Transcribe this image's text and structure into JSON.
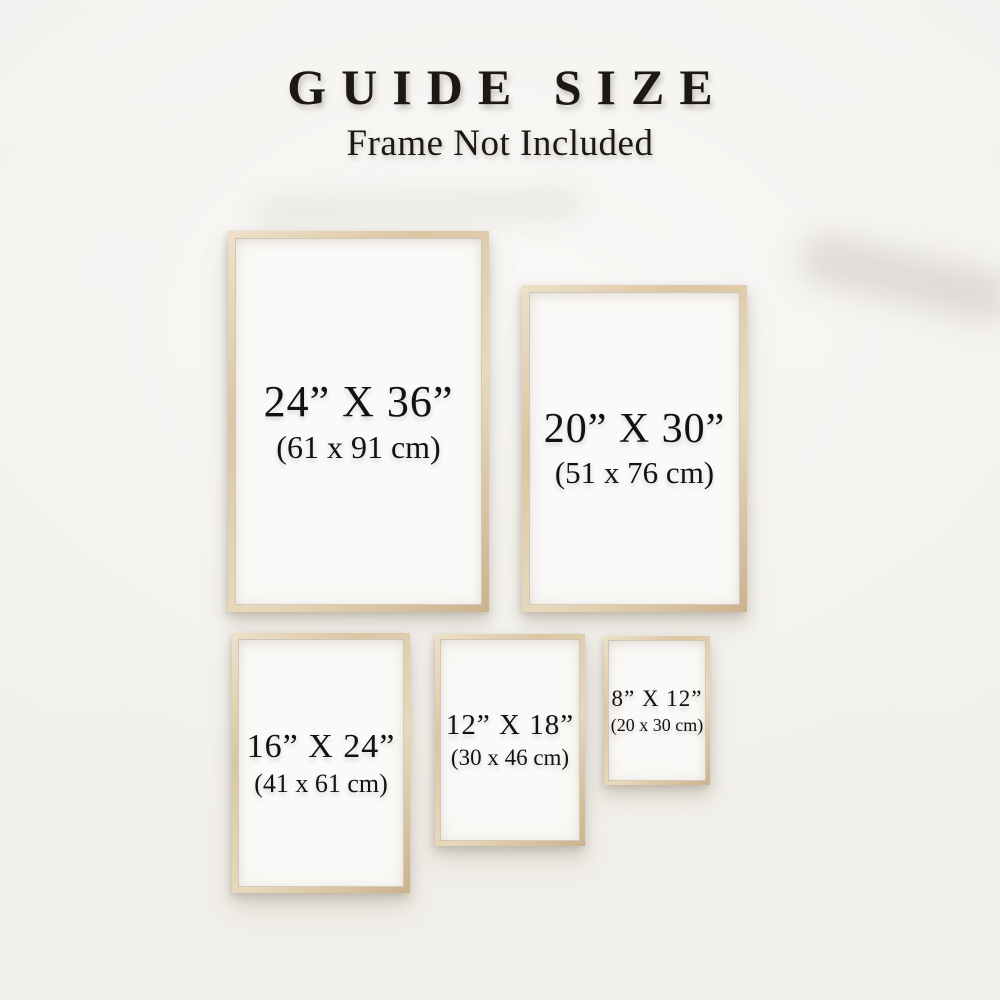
{
  "header": {
    "title": "GUIDE SIZE",
    "subtitle": "Frame Not Included"
  },
  "frames": [
    {
      "name": "24x36",
      "size_in": "24” X 36”",
      "size_cm": "(61 x 91 cm)"
    },
    {
      "name": "20x30",
      "size_in": "20” X 30”",
      "size_cm": "(51 x 76 cm)"
    },
    {
      "name": "16x24",
      "size_in": "16” X 24”",
      "size_cm": "(41 x 61 cm)"
    },
    {
      "name": "12x18",
      "size_in": "12” X 18”",
      "size_cm": "(30 x 46 cm)"
    },
    {
      "name": "8x12",
      "size_in": "8” X 12”",
      "size_cm": "(20 x 30 cm)"
    }
  ],
  "colors": {
    "wall_background": "#f2f0ec",
    "frame_wood": "#dcc8aa",
    "frame_wood_highlight": "#eee1c8",
    "frame_wood_shadow": "#ccb28e",
    "paper": "#fbfaf8",
    "text": "#141210"
  }
}
